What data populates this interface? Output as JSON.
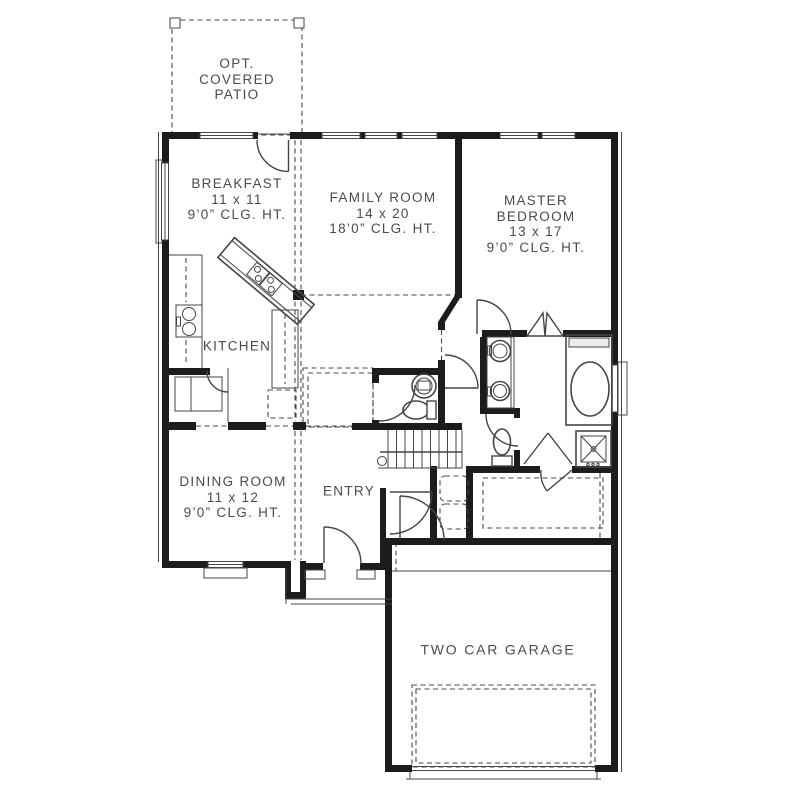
{
  "title": "First Floor Plan",
  "colors": {
    "wall": "#1c1c1e",
    "line": "#454547",
    "dash": "#4a4a4c",
    "text": "#4b4b4d",
    "bg": "#ffffff"
  },
  "rooms": {
    "patio": [
      "OPT.",
      "COVERED",
      "PATIO"
    ],
    "breakfast": [
      "BREAKFAST",
      "11 x 11",
      "9’0” CLG. HT."
    ],
    "family": [
      "FAMILY ROOM",
      "14 x 20",
      "18’0” CLG. HT."
    ],
    "master": [
      "MASTER",
      "BEDROOM",
      "13 x 17",
      "9’0” CLG. HT."
    ],
    "kitchen": [
      "KITCHEN"
    ],
    "dining": [
      "DINING ROOM",
      "11 x 12",
      "9’0” CLG. HT."
    ],
    "entry": [
      "ENTRY"
    ],
    "garage": [
      "TWO CAR GARAGE"
    ]
  }
}
